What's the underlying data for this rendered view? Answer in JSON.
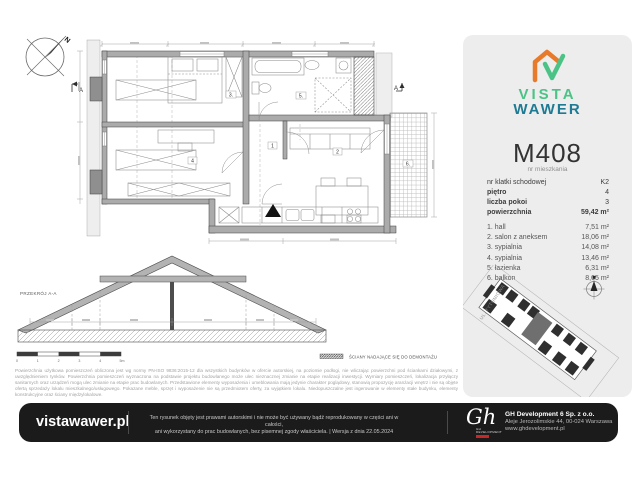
{
  "brand": {
    "vista": "VISTA",
    "wawer": "WAWER",
    "apartment_number": "M408",
    "apartment_number_label": "nr mieszkania",
    "colors": {
      "orange": "#E87A2B",
      "green": "#4CC386",
      "teal": "#1E7B93",
      "red": "#C62828"
    }
  },
  "details": [
    {
      "label": "nr klatki schodowej",
      "value": "K2"
    },
    {
      "label": "piętro",
      "value": "4"
    },
    {
      "label": "liczba pokoi",
      "value": "3"
    },
    {
      "label": "powierzchnia",
      "value": "59,42 m²"
    }
  ],
  "rooms": [
    {
      "name": "1. hall",
      "area": "7,51 m²"
    },
    {
      "name": "2. salon z aneksem",
      "area": "18,06 m²"
    },
    {
      "name": "3. sypialnia",
      "area": "14,08 m²"
    },
    {
      "name": "4. sypialnia",
      "area": "13,46 m²"
    },
    {
      "name": "5. łazienka",
      "area": "6,31 m²"
    },
    {
      "name": "6. balkon",
      "area": "8,05 m²"
    }
  ],
  "site_map": {
    "street": "UL. TYTONIOWA"
  },
  "plan": {
    "room_labels": [
      "1",
      "2",
      "3.",
      "4",
      "5.",
      "6."
    ],
    "compass_n": "N",
    "section_marker_left": "A",
    "section_marker_right": "A",
    "section_label": "PRZEKRÓJ A-A",
    "legend_label": "ŚCIANY NADAJĄCE SIĘ DO DEMONTAŻU",
    "scale_labels": [
      "0",
      "1",
      "2",
      "3",
      "4",
      "5m"
    ]
  },
  "disclaimer": "Powierzchnia użytkowa pomieszczeń obliczona jest wg normy PN-ISO 9836:2015-12 dla wszystkich budynków w ofercie autorskiej, na poziomie podłogi, nie wliczając powierzchni pod ściankami działowymi, z uwzględnieniem tynków. Powierzchnia pomieszczeń wyznaczona na podstawie projektu budowlanego może ulec nieznacznej zmianie na etapie realizacji inwestycji. Wymiary pomieszczeń, lokalizacja przyłączy sanitarnych oraz urządzeń mogą ulec zmianie na etapie prac budowlanych. Przedstawione elementy wyposażenia i umeblowania mają jedynie charakter poglądowy, stanowią propozycję aranżacji wnętrz i nie są objęte ofertą sprzedaży lokalu mieszkalnego/usługowego. Pokazane meble, sprzęt i wyposażenie nie są przedmiotem oferty, za wyjątkiem lokalu. Niedopuszczalne jest ingerowanie w elementy stałe budynku, elementy konstrukcyjne oraz ściany międzylokalowe.",
  "footer": {
    "site": "vistawawer.pl",
    "copyright": "Ten rysunek objęty jest prawami autorskimi i nie może być używany bądź reprodukowany w części ani w całości,\nani wykorzystany do prac budowlanych, bez pisemnej zgody właściciela. | Wersja z dnia 22.05.2024",
    "gh_script": "Gh",
    "gh_sub": "GH DEVELOPMENT",
    "company": "GH Development 6 Sp. z o.o.",
    "address": "Aleje Jerozolimskie 44, 00-024 Warszawa",
    "website": "www.ghdevelopment.pl"
  }
}
